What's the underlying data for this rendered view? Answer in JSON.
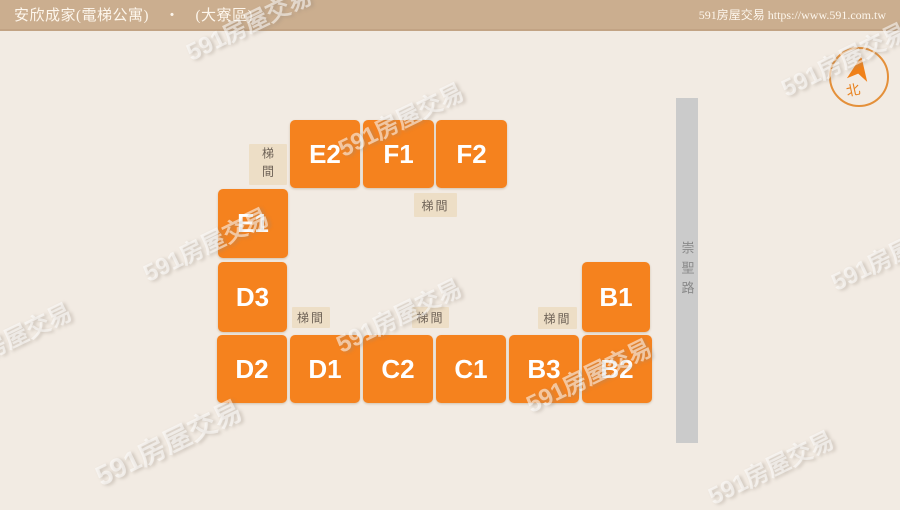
{
  "header": {
    "title": "安欣成家(電梯公寓)　‧　(大寮區)",
    "site": "591房屋交易 https://www.591.com.tw"
  },
  "plan": {
    "buildings": [
      {
        "label": "E2"
      },
      {
        "label": "F1"
      },
      {
        "label": "F2"
      },
      {
        "label": "E1"
      },
      {
        "label": "D3"
      },
      {
        "label": "B1"
      },
      {
        "label": "D2"
      },
      {
        "label": "D1"
      },
      {
        "label": "C2"
      },
      {
        "label": "C1"
      },
      {
        "label": "B3"
      },
      {
        "label": "B2"
      }
    ],
    "stairwell_label": "梯間",
    "road_name": "崇聖路",
    "compass_label": "北"
  },
  "watermark": {
    "text": "591房屋交易"
  },
  "colors": {
    "header_bg": "#cbae8f",
    "background": "#f2ebe3",
    "building_orange": "#f5821e",
    "stairwell_bg": "#eddec6",
    "road_gray": "#cbcbcb",
    "compass_orange": "#e8821e"
  }
}
